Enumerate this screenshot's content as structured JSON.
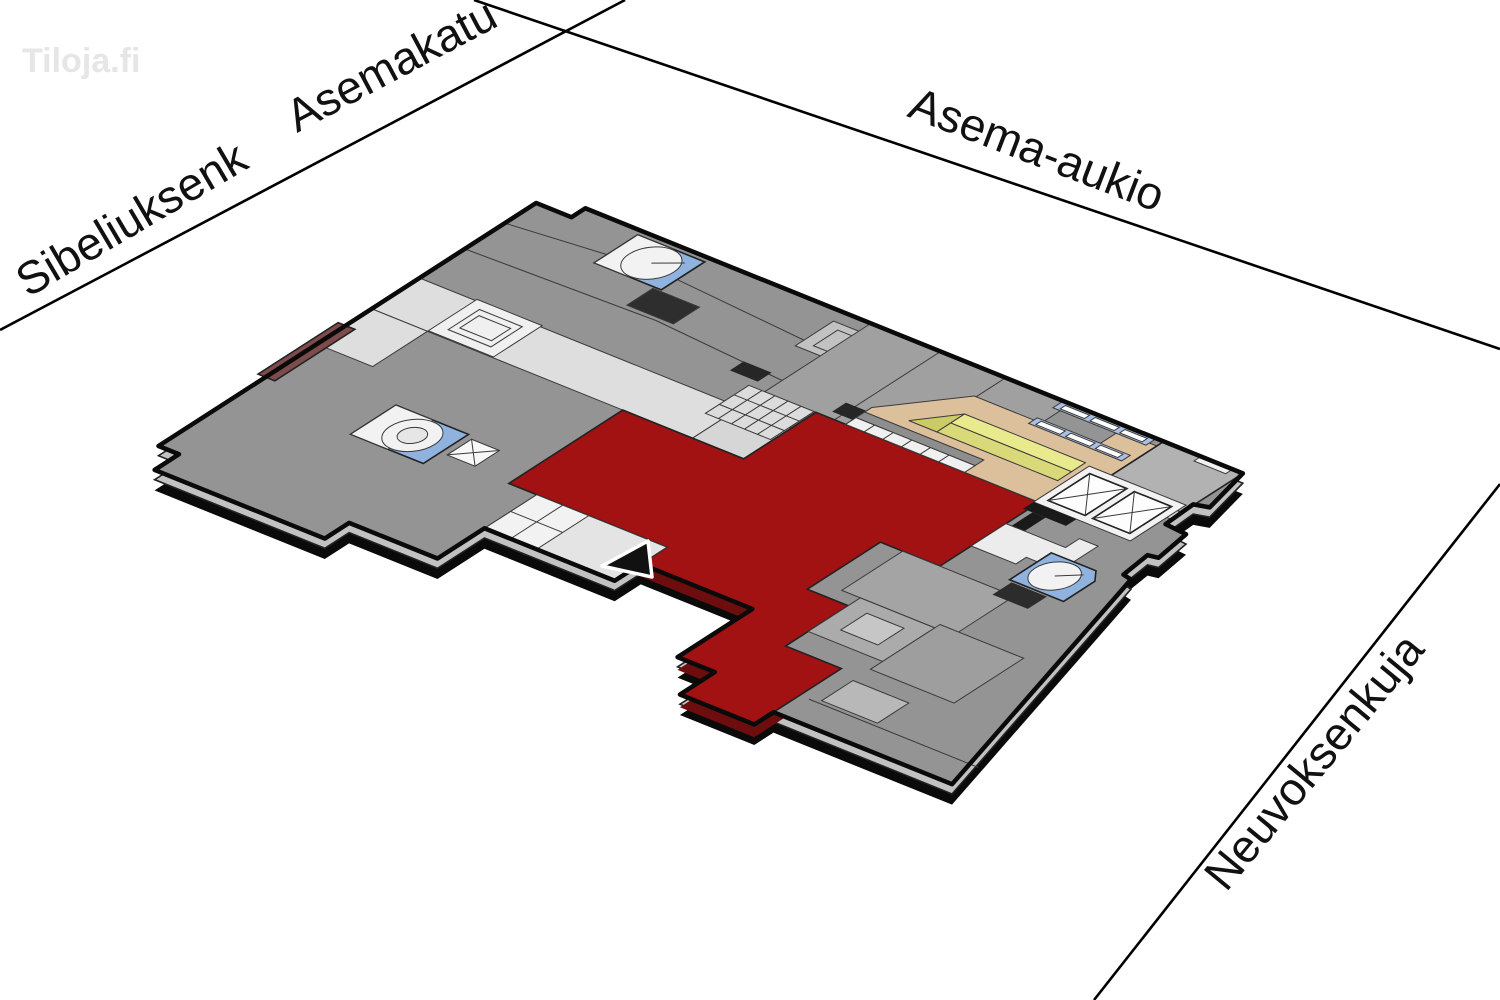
{
  "logo": {
    "text": "Tiloja.fi"
  },
  "streets": {
    "sibeliuksenkatu": {
      "label": "Sibeliuksenk"
    },
    "asemakatu": {
      "label": "Asemakatu"
    },
    "asema_aukio": {
      "label": "Asema-aukio"
    },
    "neuvoksenkuja": {
      "label": "Neuvoksenkuja"
    }
  },
  "map": {
    "type": "isometric-floor-plan",
    "highlighted_space": "red highlighted rental space",
    "icons": [
      "stairwell-icon",
      "elevator-icon",
      "entrance-arrow-icon",
      "ramp-icon",
      "glass-wall-icon"
    ]
  },
  "colors": {
    "highlight": "#a21212",
    "highlight_side": "#6e0d0d",
    "floor": "#949494",
    "floor_side": "#c2c2c2",
    "outline": "#0a0a0a",
    "public_area": "#dcc09c",
    "stair_blue": "#8fb2de",
    "ramp_yellow": "#e9e98e",
    "ramp_yellow_dark": "#d9d979",
    "wall_maroon": "#7d4b4b",
    "corridor_light": "#e4e4e4"
  }
}
